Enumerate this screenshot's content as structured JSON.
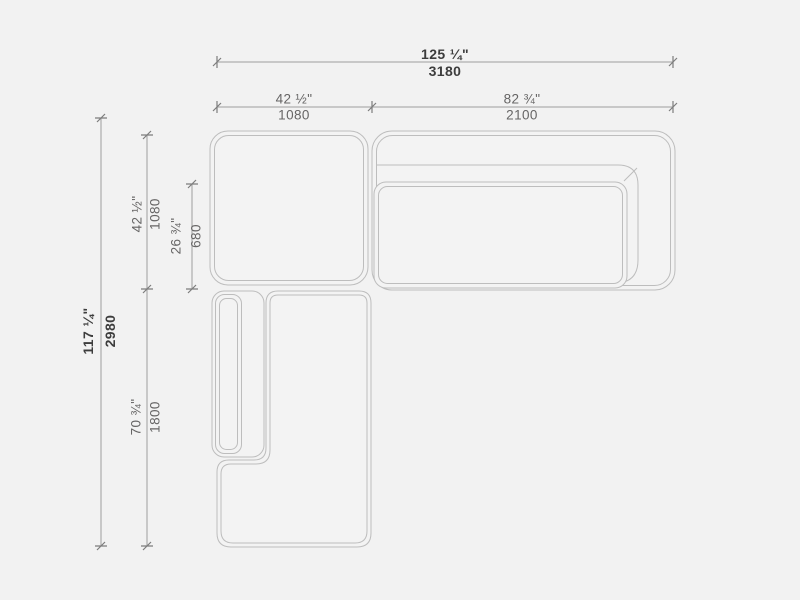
{
  "drawing_title": "sectional-sofa-plan-view",
  "units": {
    "primary": "inches",
    "secondary": "mm"
  },
  "colors": {
    "background": "#f2f2f2",
    "furniture_line": "#bdbdbd",
    "dimension_line": "#9e9e9e",
    "tick": "#7d7d7d",
    "label_text": "#666565",
    "label_text_emphasis": "#3d3d3d"
  },
  "dims": {
    "overall_width": {
      "in": "125 ¼\"",
      "mm": "3180",
      "emphasis": true
    },
    "corner_width": {
      "in": "42 ½\"",
      "mm": "1080",
      "emphasis": false
    },
    "right_width": {
      "in": "82 ¾\"",
      "mm": "2100",
      "emphasis": false
    },
    "overall_depth": {
      "in": "117 ¼\"",
      "mm": "2980",
      "emphasis": true
    },
    "corner_depth": {
      "in": "42 ½\"",
      "mm": "1080",
      "emphasis": false
    },
    "seat_depth": {
      "in": "26 ¾\"",
      "mm": "680",
      "emphasis": false
    },
    "chaise_length": {
      "in": "70 ¾\"",
      "mm": "1800",
      "emphasis": false
    }
  }
}
